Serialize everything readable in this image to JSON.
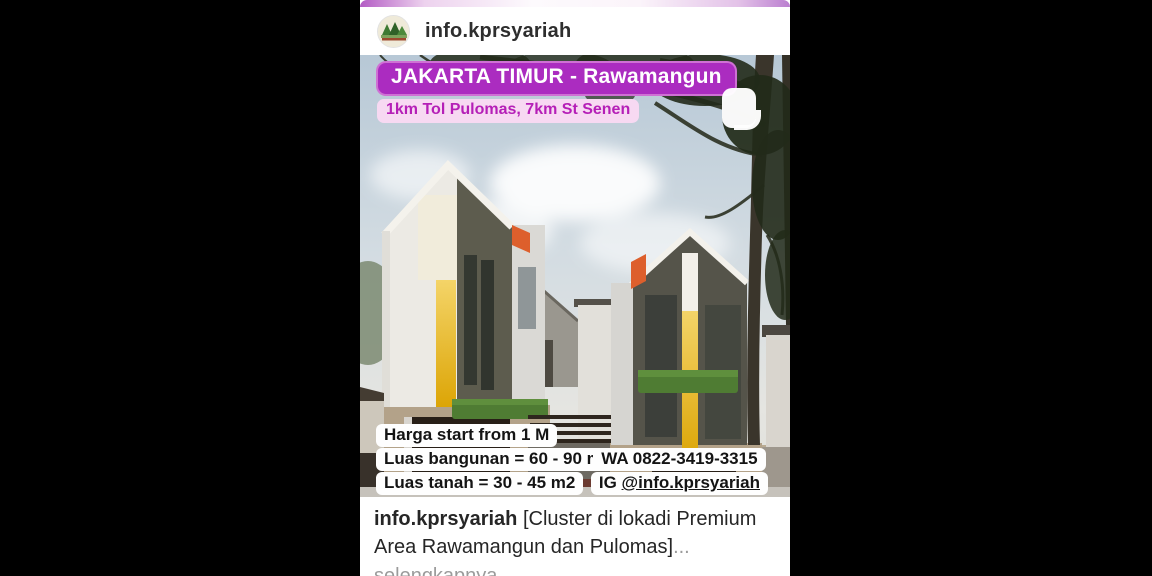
{
  "post": {
    "header": {
      "username": "info.kprsyariah"
    },
    "photo": {
      "location_badge": "JAKARTA TIMUR - Rawamangun",
      "distance_badge": "1km Tol Pulomas, 7km St Senen",
      "price_lines": [
        "Harga start from 1 M",
        "Luas bangunan = 60 - 90 m2",
        "Luas tanah = 30 - 45 m2"
      ],
      "contact": {
        "whatsapp": "WA 0822-3419-3315",
        "ig_prefix": "IG ",
        "ig_handle": "@info.kprsyariah"
      }
    },
    "caption": {
      "username": "info.kprsyariah",
      "text": " [Cluster di lokadi Premium Area Rawamangun dan Pulomas]",
      "ellipsis": "...",
      "more_label": "selengkapnya"
    },
    "colors": {
      "location_badge_bg": "#ab2cc0",
      "distance_badge_bg": "#f7d9f2",
      "distance_badge_text": "#b51fb7",
      "house_accent_yellow": "#e2ab08",
      "house_accent_orange": "#dd5f2c",
      "letterbox": "#000000"
    }
  }
}
